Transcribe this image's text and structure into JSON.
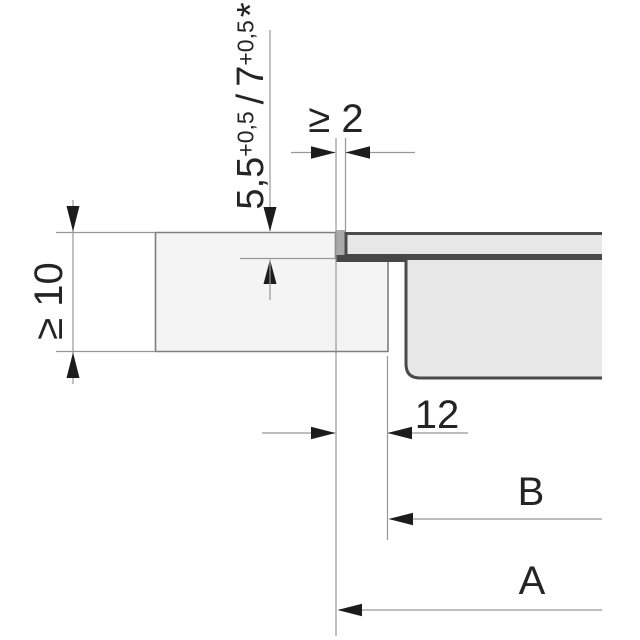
{
  "labels": {
    "recess_depth": {
      "value_standard": "5,5",
      "tolerance_standard": "+0,5",
      "separator": "/",
      "value_alternative": "7",
      "tolerance_alternative": "+0,5",
      "footnote_marker": "*"
    },
    "joint_gap": "≥ 2",
    "worktop_thickness": "≥ 10",
    "rebate_width": "12",
    "dimension_b": "B",
    "dimension_a": "A"
  },
  "colors": {
    "worktop_fill": "#f4f4f4",
    "appliance_fill": "#e7e7e7",
    "joint_fill": "#a9a9a9",
    "seal_fill": "#474747",
    "appliance_outline": "#4a4a4a",
    "worktop_outline": "#7e7e7e",
    "dimension_line": "#989898",
    "arrow_fill": "#1c1c1c",
    "label_text": "#242424"
  }
}
